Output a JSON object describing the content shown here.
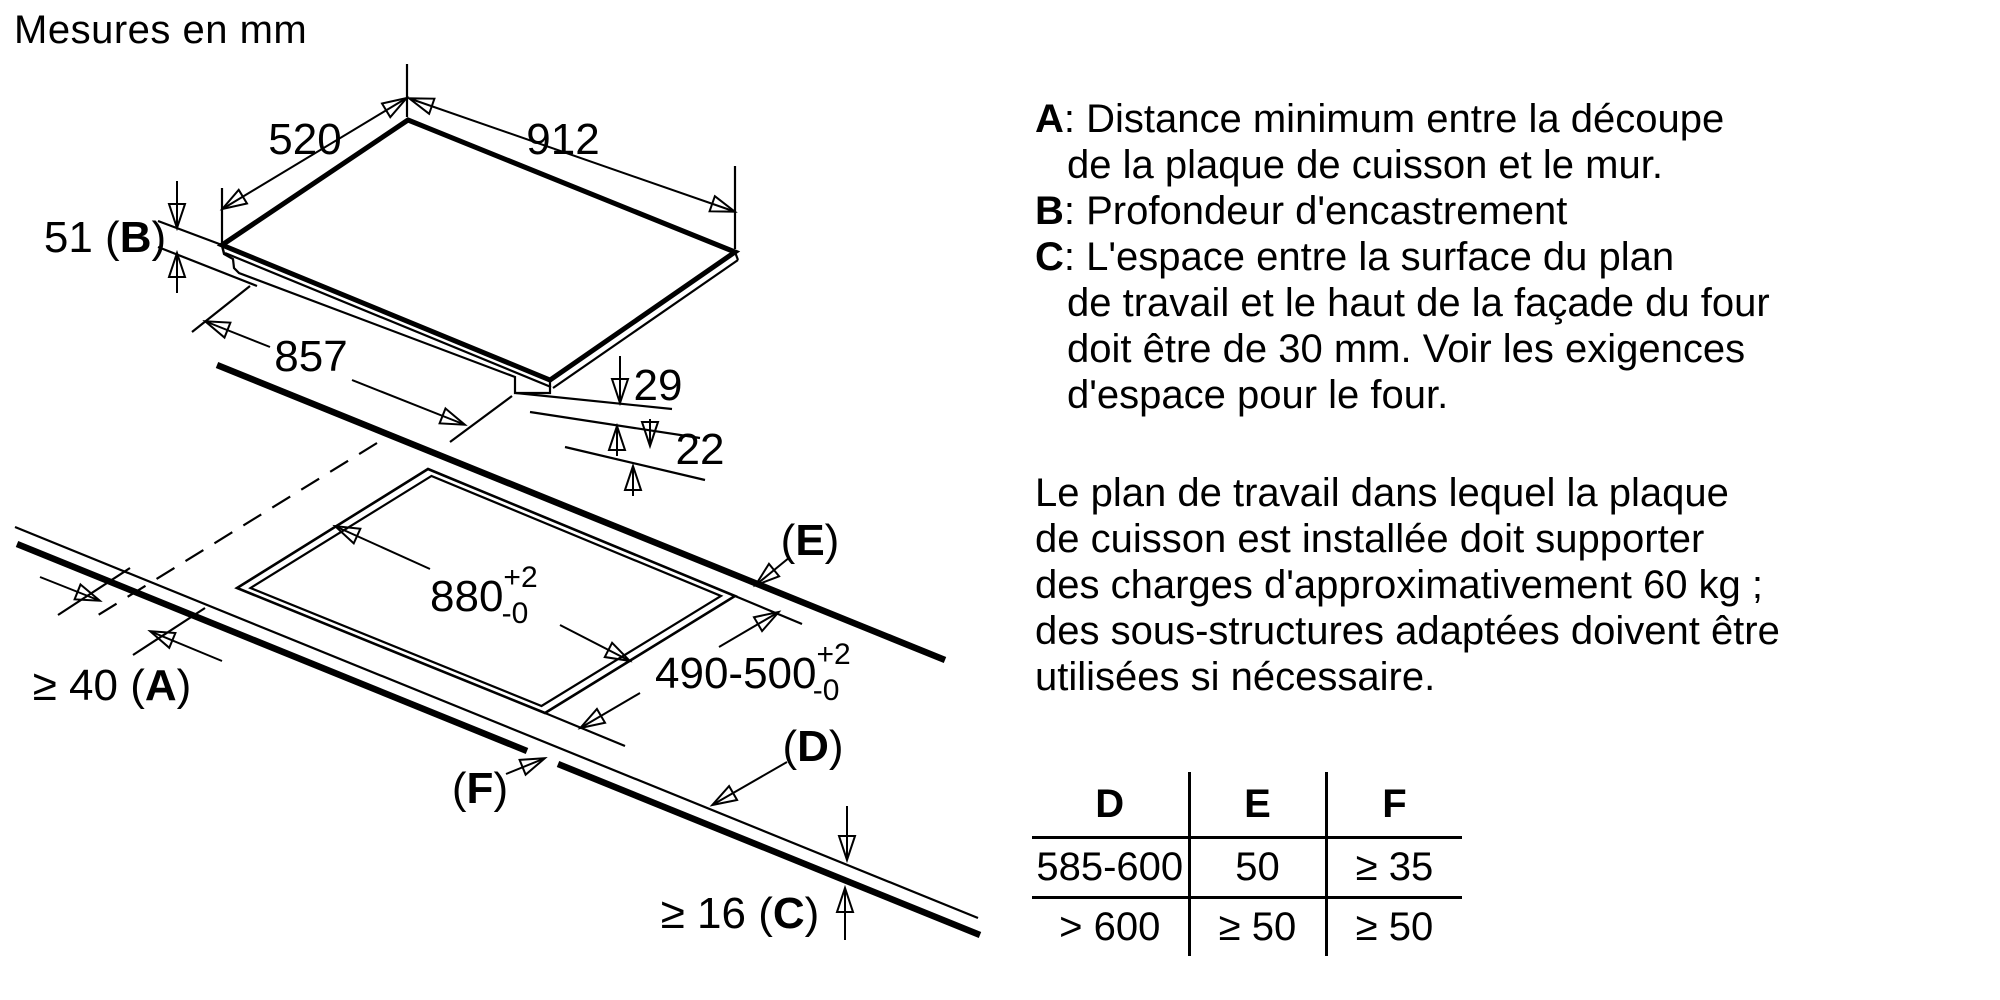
{
  "title": "Mesures en mm",
  "sep": ": ",
  "diagram": {
    "dims": {
      "width": "520",
      "length": "912",
      "base": "857",
      "step1": "29",
      "step2": "22",
      "depth": {
        "pre": "51 (",
        "letter": "B",
        "post": ")"
      },
      "cutout_length": {
        "main": "880",
        "sup": "+2",
        "sub": "-0"
      },
      "cutout_width": {
        "main": "490-500",
        "sup": "+2",
        "sub": "-0"
      },
      "wall": {
        "pre": "≥ 40 (",
        "letter": "A",
        "post": ")"
      },
      "e": {
        "pre": "(",
        "letter": "E",
        "post": ")"
      },
      "d": {
        "pre": "(",
        "letter": "D",
        "post": ")"
      },
      "f": {
        "pre": "(",
        "letter": "F",
        "post": ")"
      },
      "thickness": {
        "pre": "≥ 16 (",
        "letter": "C",
        "post": ")"
      }
    }
  },
  "notes": [
    {
      "label": "A",
      "lines": [
        "Distance minimum entre la découpe",
        "de la plaque de cuisson et le mur."
      ]
    },
    {
      "label": "B",
      "lines": [
        "Profondeur d'encastrement"
      ]
    },
    {
      "label": "C",
      "lines": [
        "L'espace entre la surface du plan",
        "de travail et le haut de la façade du four",
        "doit être de 30 mm. Voir les exigences",
        "d'espace pour le four."
      ]
    }
  ],
  "paragraph": [
    "Le plan de travail dans lequel la plaque",
    "de cuisson est installée doit supporter",
    "des charges d'approximativement 60 kg ;",
    "des sous-structures adaptées doivent être",
    "utilisées si nécessaire."
  ],
  "table": {
    "headers": [
      "D",
      "E",
      "F"
    ],
    "rows": [
      [
        "585-600",
        "50",
        "≥ 35"
      ],
      [
        "> 600",
        "≥ 50",
        "≥ 50"
      ]
    ]
  }
}
